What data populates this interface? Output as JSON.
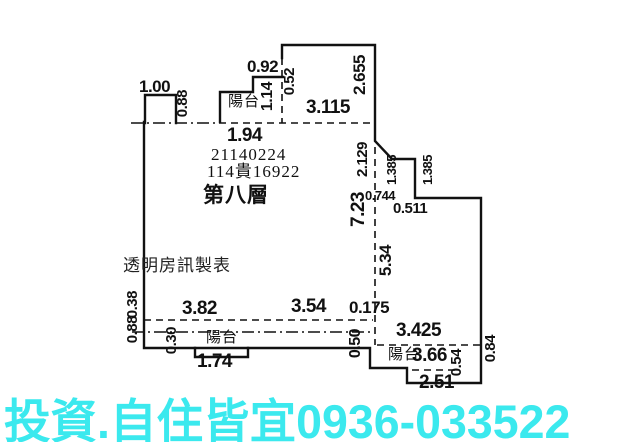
{
  "plan": {
    "case_number": "21140224",
    "case_code": "114貴16922",
    "floor_label": "第八層",
    "watermark": "透明房訊製表",
    "balcony": "陽台",
    "dims": {
      "v100": "1.00",
      "v088": "0.88",
      "v092": "0.92",
      "v052": "0.52",
      "v114": "1.14",
      "v194": "1.94",
      "v3115": "3.115",
      "v2655": "2.655",
      "v2129": "2.129",
      "v1385": "1.385",
      "v0744": "0.744",
      "v0511": "0.511",
      "v723": "7.23",
      "v534": "5.34",
      "v038": "0.38",
      "v382": "3.82",
      "v354": "3.54",
      "v0175": "0.175",
      "v030": "0.30",
      "v174": "1.74",
      "v050": "0.50",
      "v3425": "3.425",
      "v366": "3.66",
      "v054": "0.54",
      "v251": "2.51",
      "v084": "0.84"
    }
  },
  "footer": {
    "ad_text": "投資.自住皆宜0936-033522",
    "color": "#3be9ee"
  },
  "colors": {
    "line": "#111111",
    "background": "#ffffff"
  }
}
